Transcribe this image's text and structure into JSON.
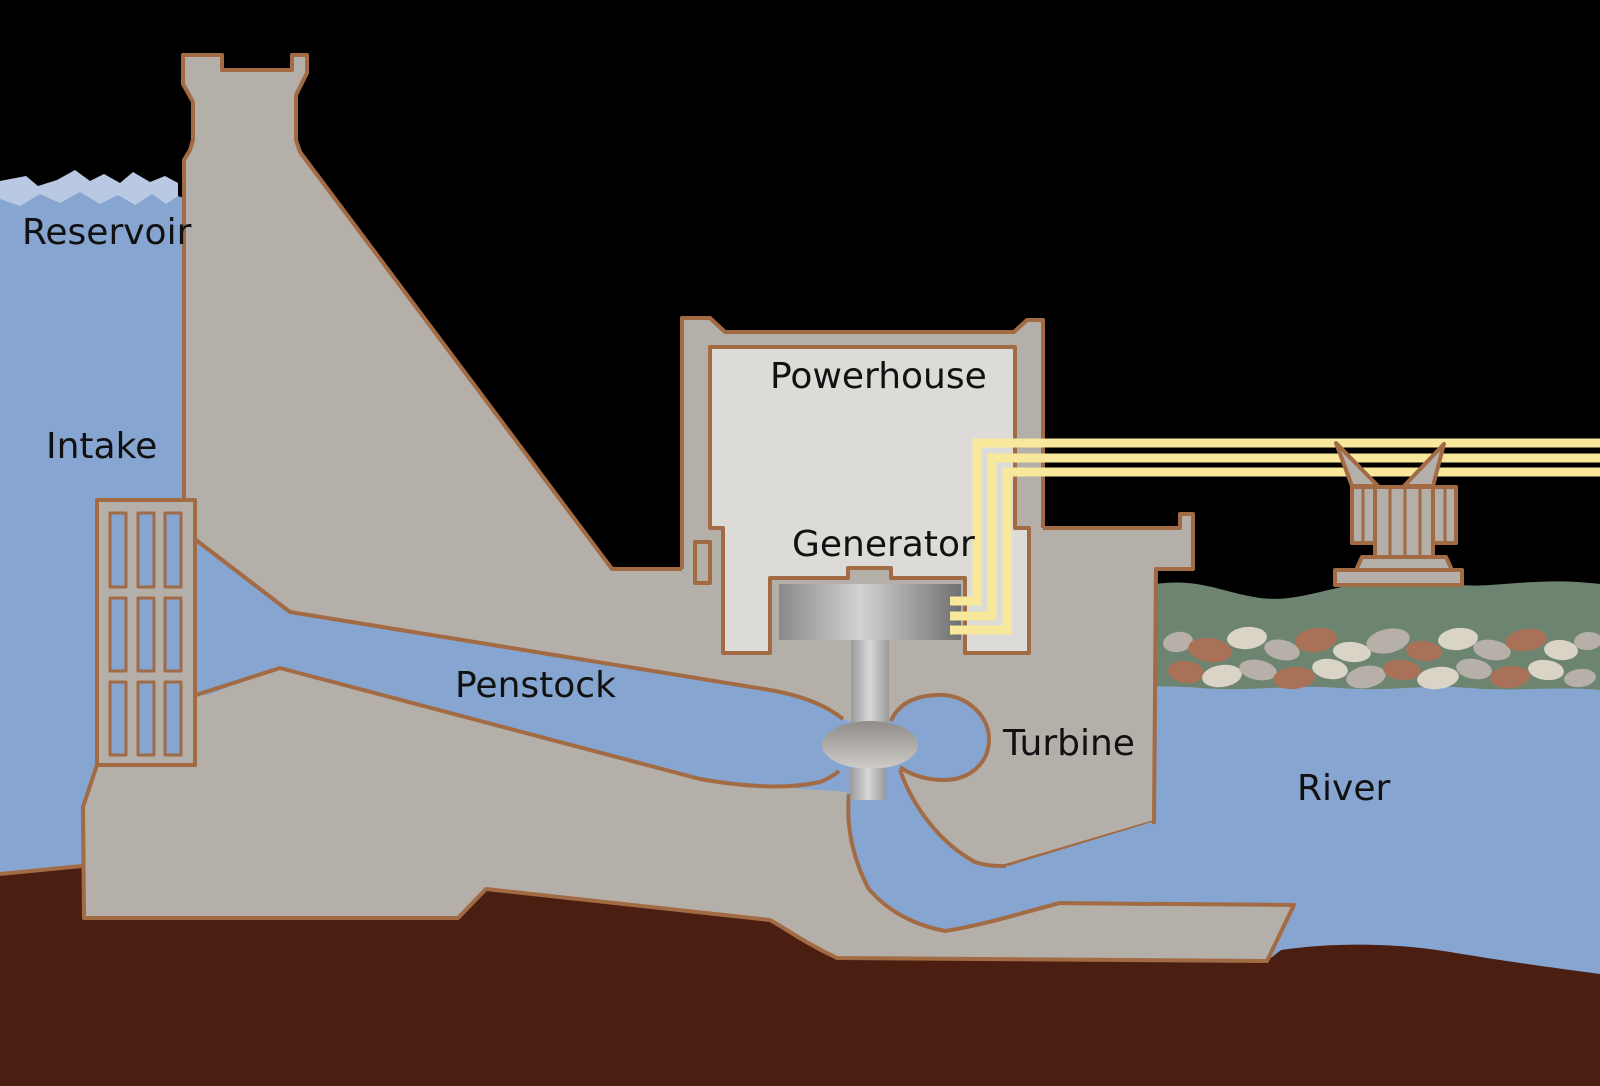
{
  "diagram": {
    "type": "hydroelectric-dam-cross-section",
    "labels": {
      "reservoir": "Reservoir",
      "intake": "Intake",
      "penstock": "Penstock",
      "powerhouse": "Powerhouse",
      "generator": "Generator",
      "turbine": "Turbine",
      "river": "River"
    },
    "colors": {
      "background": "#000000",
      "water": "#87a5d1",
      "water_highlight": "#b9c9e3",
      "structure": "#b4afa9",
      "structure_light": "#dddbd7",
      "outline": "#a26b44",
      "ground": "#4b1e12",
      "power_line": "#f8e89c",
      "bank_green": "#6d8570",
      "rock_gray": "#b6b0a9",
      "rock_brown": "#a97258",
      "rock_cream": "#dad4c6",
      "label_text": "#111111"
    }
  }
}
